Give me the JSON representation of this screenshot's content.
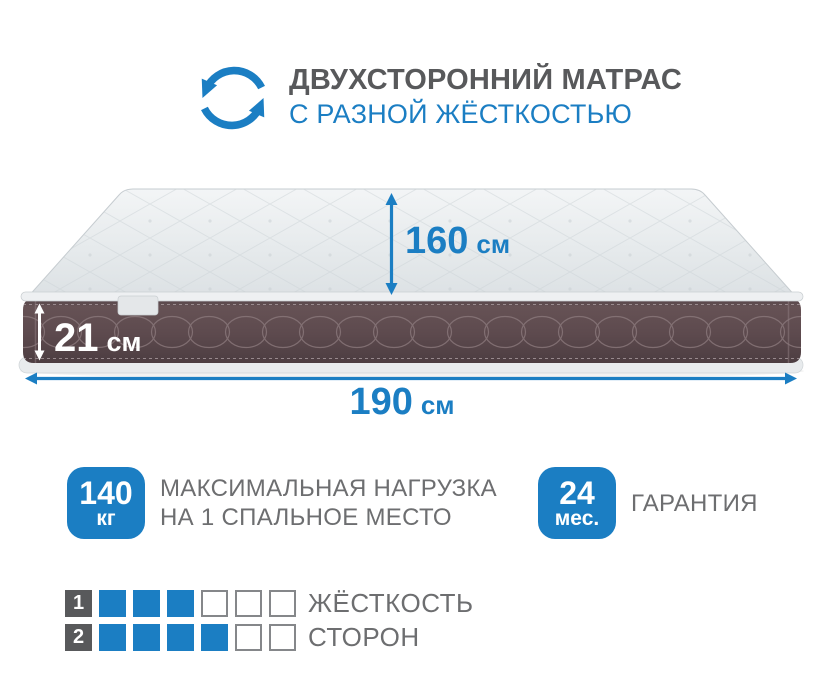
{
  "header": {
    "icon": "rotate-arrows",
    "title": "ДВУХСТОРОННИЙ МАТРАС",
    "subtitle": "С РАЗНОЙ ЖЁСТКОСТЬЮ"
  },
  "dimensions": {
    "depth": {
      "value": "160",
      "unit": "см"
    },
    "thickness": {
      "value": "21",
      "unit": "см"
    },
    "width": {
      "value": "190",
      "unit": "см"
    }
  },
  "features": [
    {
      "badge_value": "140",
      "badge_unit": "кг",
      "line1": "МАКСИМАЛЬНАЯ НАГРУЗКА",
      "line2": "НА 1 СПАЛЬНОЕ МЕСТО"
    },
    {
      "badge_value": "24",
      "badge_unit": "мес.",
      "line1": "ГАРАНТИЯ",
      "line2": ""
    }
  ],
  "firmness": {
    "rows": [
      {
        "num": "1",
        "filled": 3,
        "total": 6,
        "label": "ЖЁСТКОСТЬ"
      },
      {
        "num": "2",
        "filled": 4,
        "total": 6,
        "label": "СТОРОН"
      }
    ]
  },
  "colors": {
    "accent_blue": "#1b7ec3",
    "title_gray": "#58595b",
    "text_gray": "#6d6e70",
    "side_plum": "#5d4a4e",
    "cell_border": "#85878a"
  }
}
